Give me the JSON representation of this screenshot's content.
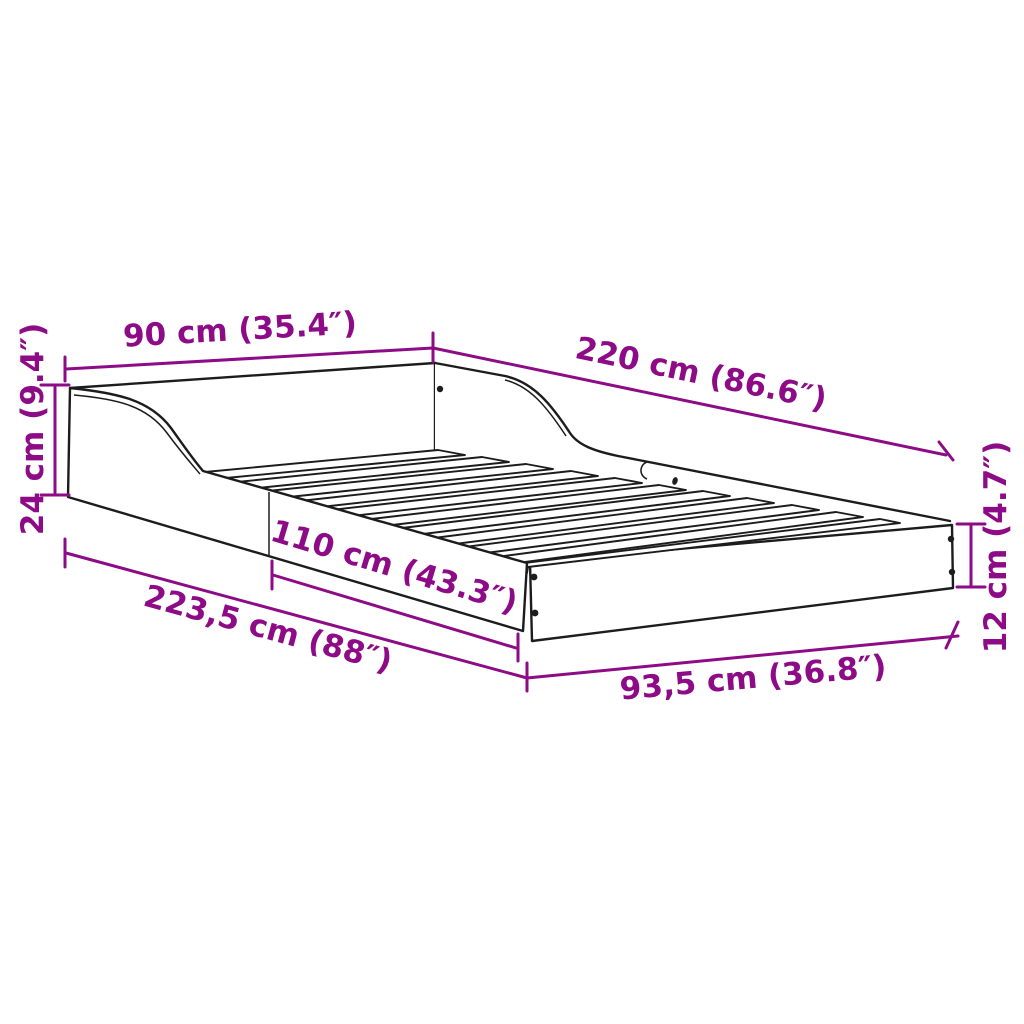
{
  "diagram": {
    "type": "product-dimension-diagram",
    "subject": "bed-frame-with-slats",
    "background_color": "#ffffff",
    "outline_color": "#1c1c1c",
    "accent_color": "#8d0b86",
    "slat_count": 11,
    "dimensions": {
      "head_width": {
        "label": "90 cm (35.4″)"
      },
      "length": {
        "label": "220 cm (86.6″)"
      },
      "head_height": {
        "label": "24 cm (9.4″)"
      },
      "rail_section": {
        "label": "110 cm (43.3″)"
      },
      "total_length": {
        "label": "223,5 cm (88″)"
      },
      "foot_width": {
        "label": "93,5 cm (36.8″)"
      },
      "foot_height": {
        "label": "12 cm (4.7″)"
      }
    }
  }
}
